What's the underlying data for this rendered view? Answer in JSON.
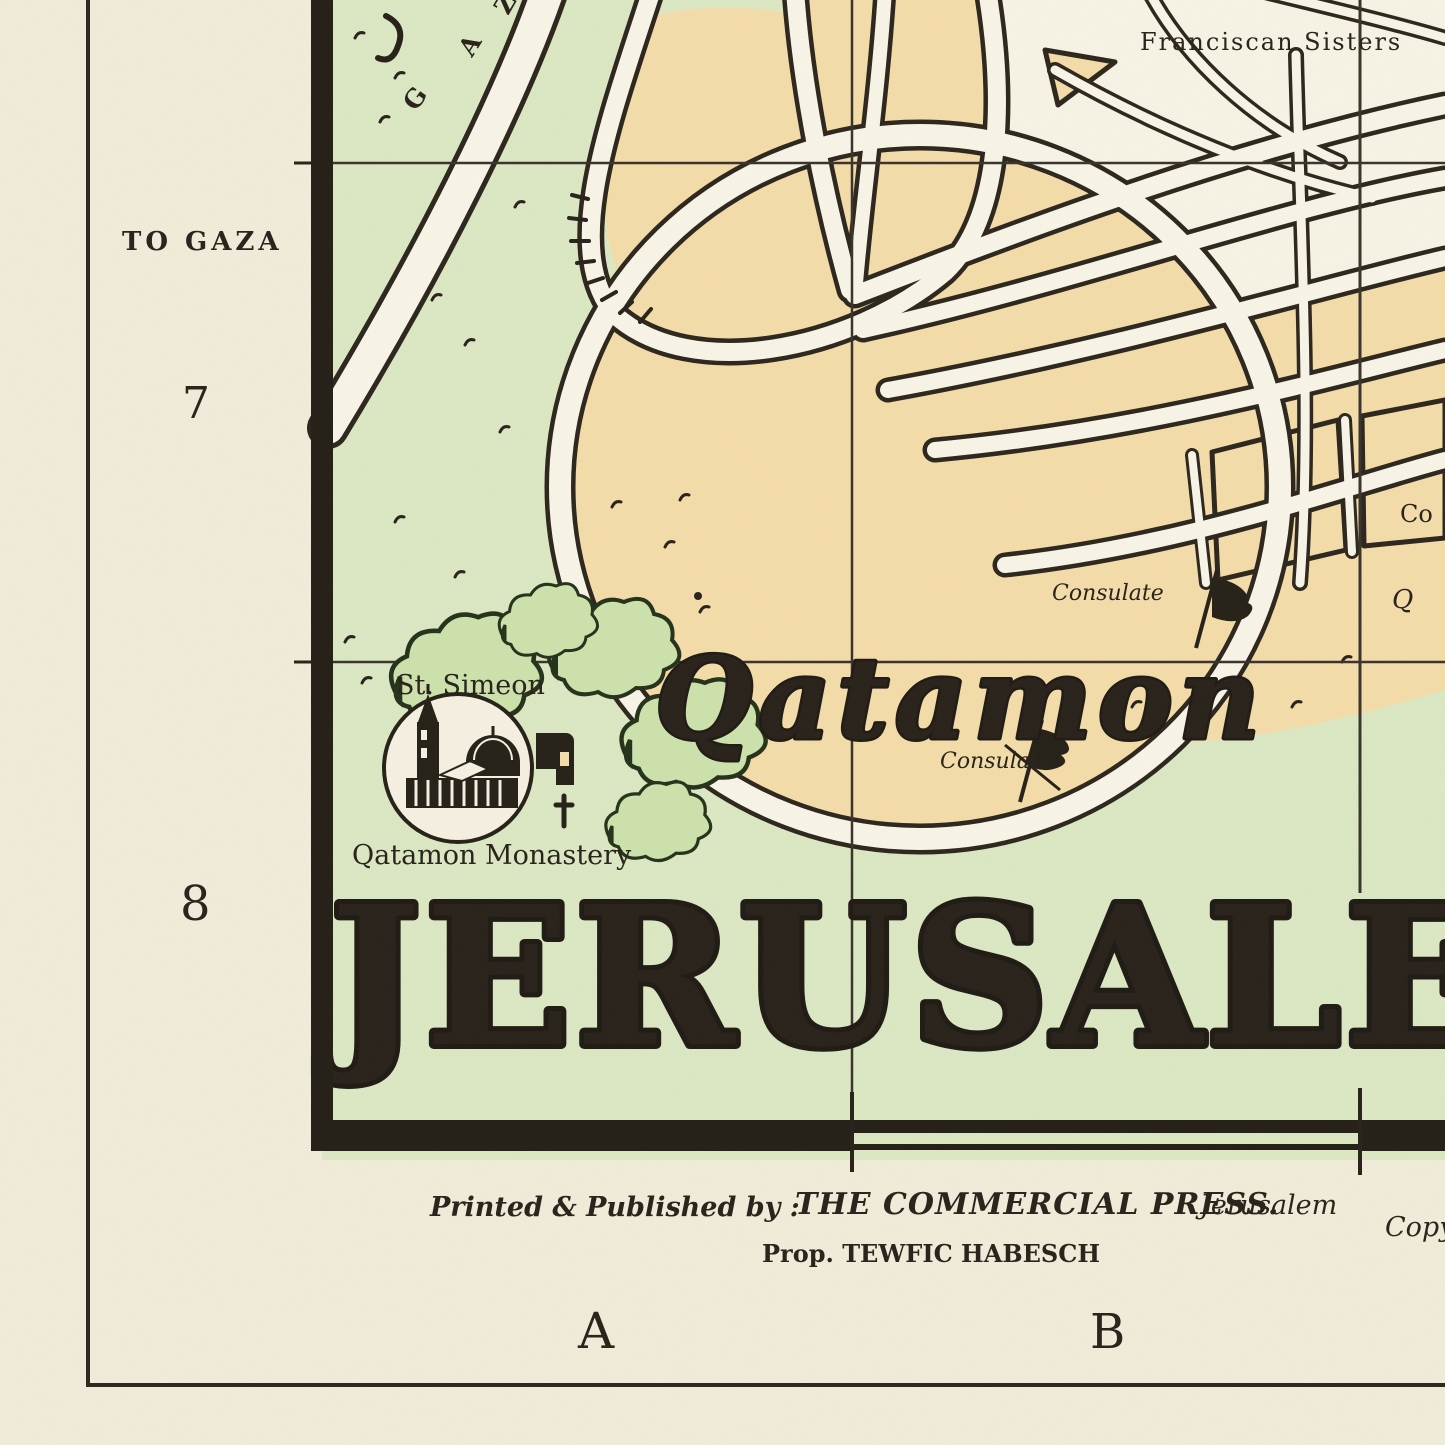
{
  "map": {
    "title": "JERUSALEM",
    "region_labels": {
      "qatamon": "Qatamon"
    },
    "labels": {
      "franciscan_sisters": "Franciscan Sisters",
      "to_gaza": "TO GAZA",
      "st_simeon": "St. Simeon",
      "qatamon_monastery": "Qatamon Monastery",
      "consulate_upper": "Consulate",
      "consulate_lower": "Consulate",
      "consulate_right_partial": "Co",
      "street_q_partial": "Q",
      "road_letters": [
        "G",
        "A",
        "Z"
      ]
    },
    "grid": {
      "row_labels": [
        "7",
        "8"
      ],
      "col_labels": [
        "A",
        "B"
      ]
    },
    "imprint": {
      "printed_by": "Printed & Published by :",
      "publisher": "THE COMMERCIAL PRESS.",
      "publisher_city": "Jerusalem",
      "proprietor": "Prop. TEWFIC HABESCH",
      "copyright_partial": "Copy"
    },
    "colors": {
      "paper_margin": "#f2eddb",
      "map_unbuilt_white": "#f8f4e6",
      "fields_green": "#dce9c4",
      "builtup_peach": "#f4dda9",
      "ink_black": "#262019"
    }
  }
}
